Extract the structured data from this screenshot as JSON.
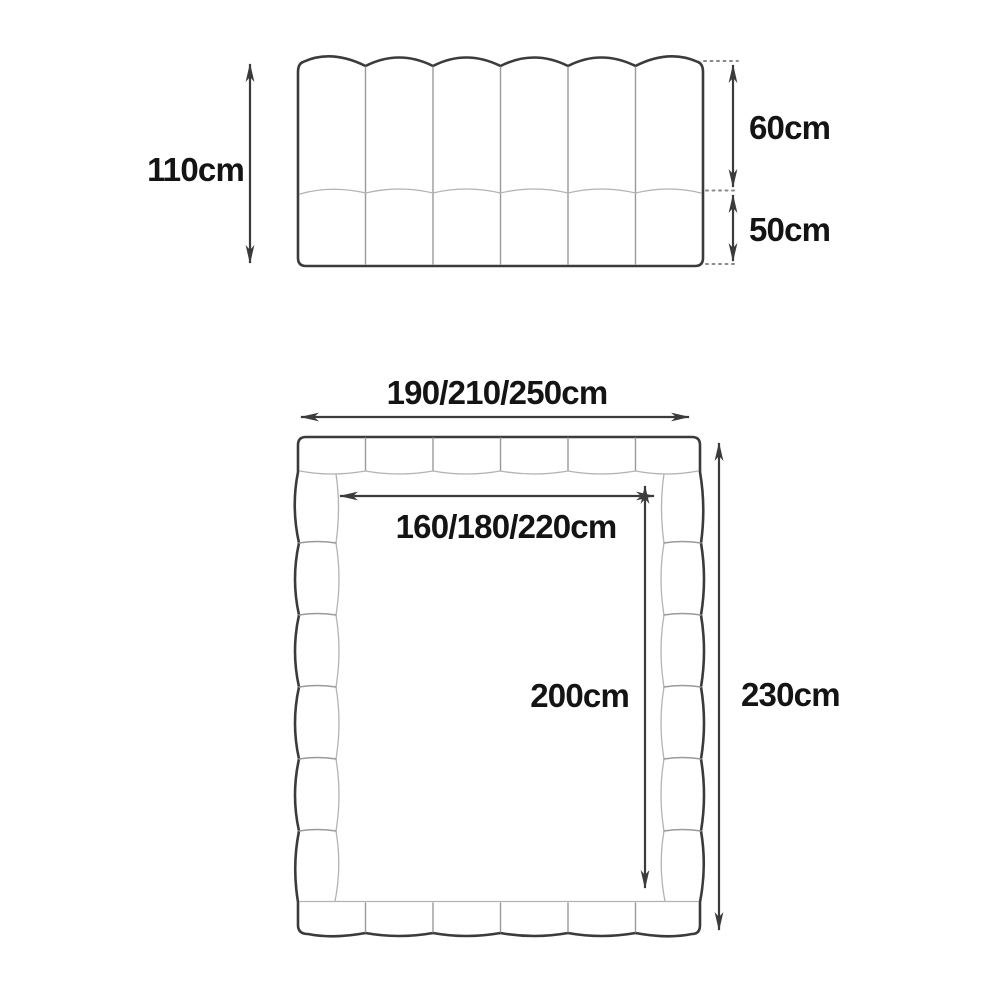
{
  "side_view": {
    "total_height": "110cm",
    "upper_section": "60cm",
    "lower_section": "50cm"
  },
  "top_view": {
    "outer_width": "190/210/250cm",
    "inner_width": "160/180/220cm",
    "inner_length": "200cm",
    "outer_length": "230cm"
  },
  "colors": {
    "outline": "#3b3b3b",
    "divider": "#9a9a9a",
    "tuft_line": "#b3b3b3",
    "dotted_line": "#8a8a8a",
    "text": "#141414",
    "background": "#ffffff"
  }
}
